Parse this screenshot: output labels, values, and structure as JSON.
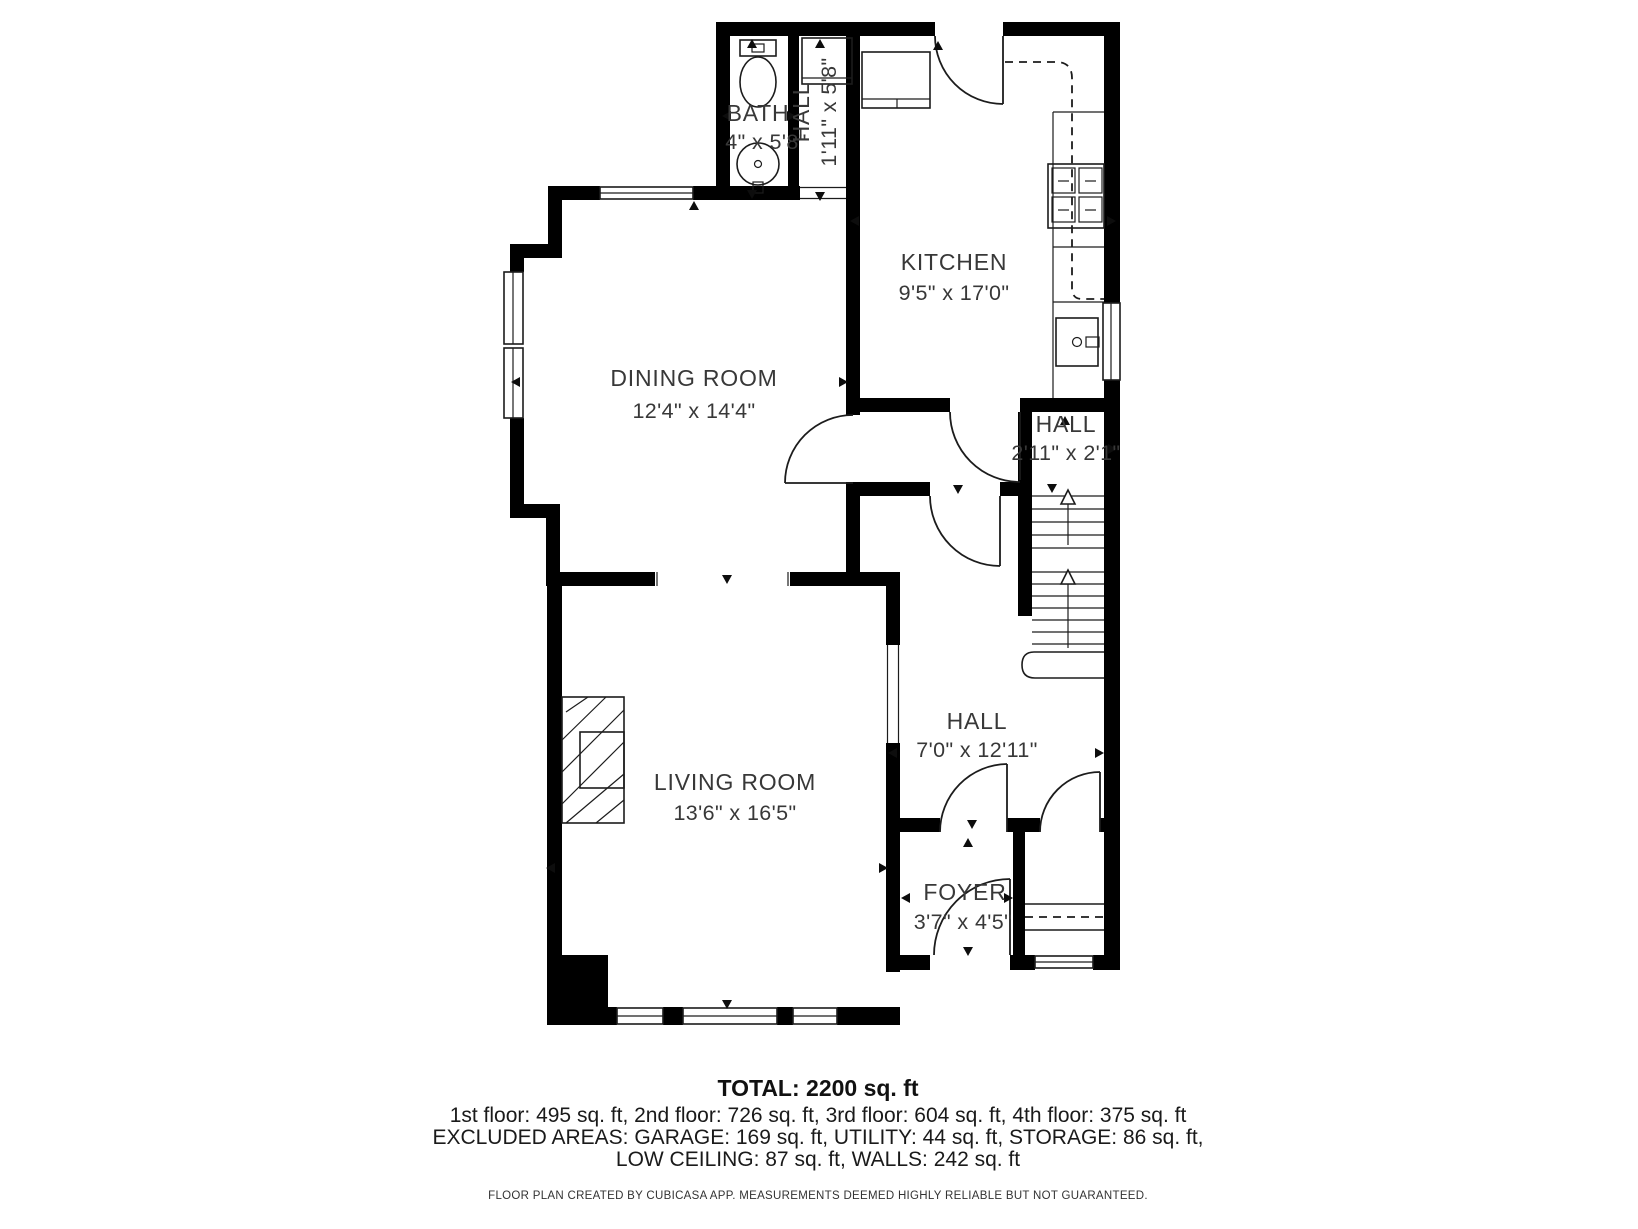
{
  "plan": {
    "rooms": [
      {
        "name": "BATH",
        "dims": "4\" x 5'8\""
      },
      {
        "name": "HALL",
        "dims": "1'11\" x 5'8\""
      },
      {
        "name": "KITCHEN",
        "dims": "9'5\" x 17'0\""
      },
      {
        "name": "DINING ROOM",
        "dims": "12'4\" x 14'4\""
      },
      {
        "name": "HALL",
        "dims": "2'11\" x 2'1\""
      },
      {
        "name": "HALL",
        "dims": "7'0\" x 12'11\""
      },
      {
        "name": "LIVING ROOM",
        "dims": "13'6\" x 16'5\""
      },
      {
        "name": "FOYER",
        "dims": "3'7\" x 4'5\""
      }
    ]
  },
  "summary": {
    "total": "TOTAL: 2200 sq. ft",
    "floors": "1st floor: 495 sq. ft, 2nd floor: 726 sq. ft, 3rd floor: 604 sq. ft, 4th floor: 375 sq. ft",
    "excluded_line1": "EXCLUDED AREAS: GARAGE: 169 sq. ft, UTILITY: 44 sq. ft, STORAGE: 86 sq. ft,",
    "excluded_line2": "LOW CEILING: 87 sq. ft, WALLS: 242 sq. ft",
    "footer": "FLOOR PLAN CREATED BY CUBICASA APP. MEASUREMENTS DEEMED HIGHLY RELIABLE BUT NOT GUARANTEED."
  },
  "colors": {
    "wall": "#000000",
    "background": "#ffffff",
    "label_text": "#383838",
    "summary_text": "#1a1a1a"
  }
}
